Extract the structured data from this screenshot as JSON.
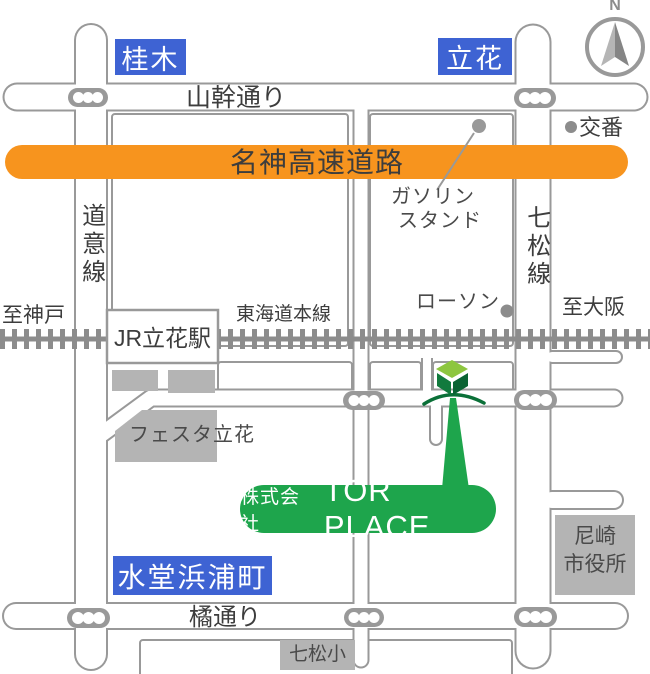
{
  "title": "TOR PLACE access map",
  "compass": {
    "north_label": "N"
  },
  "areas": {
    "katsuragi": "桂木",
    "tachibana": "立花",
    "suido_hamaura": "水堂浜浦町"
  },
  "roads": {
    "yamakan_dori": "山幹通り",
    "meishin_expressway": "名神高速道路",
    "doi_line": "道意線",
    "nanamatsu_line": "七松線",
    "tachibana_dori": "橘通り",
    "tokaido_main_line": "東海道本線"
  },
  "directions": {
    "to_kobe": "至神戸",
    "to_osaka": "至大阪"
  },
  "landmarks": {
    "koban": "交番",
    "gas_station_line1": "ガソリン",
    "gas_station_line2": "スタンド",
    "lawson": "ローソン",
    "jr_station": "JR立花駅",
    "festa_tachibana": "フェスタ立花",
    "nanamatsu_elementary": "七松小",
    "city_hall_line1": "尼崎",
    "city_hall_line2": "市役所"
  },
  "company": {
    "prefix": "株式会社",
    "name": "TOR PLACE"
  },
  "colors": {
    "accent_blue": "#3e63d3",
    "highway_orange": "#f7941e",
    "brand_green": "#1ea54c",
    "building_top_green": "#8dc63f",
    "building_left_green": "#117a3d",
    "building_right_green": "#0a6333",
    "arc_green": "#0b7038",
    "road_casing_gray": "#999999",
    "block_fill_gray": "#b4b4b4",
    "rail_gray": "#8c8c8c",
    "text_dark": "#3d3d3d",
    "white": "#ffffff"
  }
}
